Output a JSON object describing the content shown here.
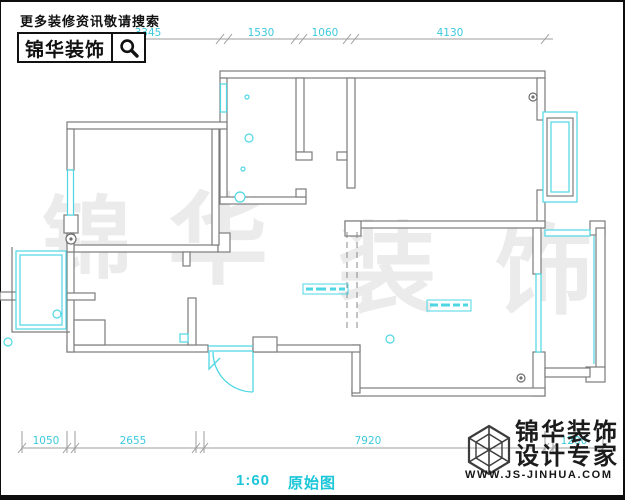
{
  "header": {
    "tagline": "更多装修资讯敬请搜索",
    "brand": "锦华装饰",
    "search_icon": "magnifier-icon"
  },
  "watermark": {
    "char1": "锦",
    "char2": "华",
    "char3": "装",
    "char4": "饰"
  },
  "dims_top": {
    "d1": "3345",
    "d2": "1530",
    "d3": "1060",
    "d4": "4130"
  },
  "dims_bottom": {
    "d1": "1050",
    "d2": "2655",
    "d3": "7920",
    "d4": "1200"
  },
  "caption": {
    "scale": "1:60",
    "name": "原始图"
  },
  "footer": {
    "brand_line1": "锦华装饰",
    "brand_line2": "设计专家",
    "website": "WWW.JS-JINHUA.COM",
    "logo_icon": "cube-wireframe-icon"
  },
  "plan": {
    "type": "floor-plan",
    "line_color_walls": "#7c7c7c",
    "line_color_fixtures": "#4ed7e3",
    "dimension_text_color": "#3cc9dc",
    "features": [
      "top-left-bedroom-with-window",
      "left-balcony",
      "small-bathroom-bottom-left",
      "kitchen-with-plumbing-circles",
      "top-right-bedroom-with-bay-window",
      "living-room-bottom-right",
      "right-balcony",
      "entry-door-with-swing-arc",
      "dashed-beam-lines",
      "two-illegible-cyan-annotation-labels"
    ]
  }
}
